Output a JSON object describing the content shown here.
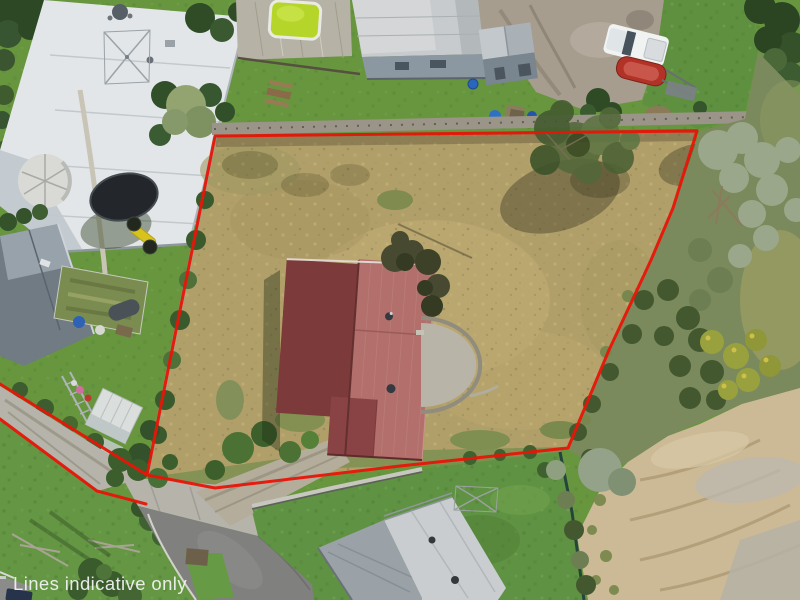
{
  "overlay": {
    "disclaimer_text": "Lines indicative only",
    "text_color": "#f4f4f4",
    "boundary_color": "#e81508"
  },
  "palette": {
    "lawn": "#68963f",
    "paddock": "#b19f69",
    "road": "#80807e",
    "concrete": "#b5b3aa",
    "sand": "#ccba96",
    "scrub": "#7b8a5c",
    "main_roof_dark": "#7c3a3b",
    "main_roof_light": "#b26f6b",
    "neighbor_roof_white": "#e3e6e8",
    "neighbor_roof_gray": "#c8cbcd",
    "gray_house_roof": "#c9cdd0",
    "pool_water": "#b6d52b"
  }
}
